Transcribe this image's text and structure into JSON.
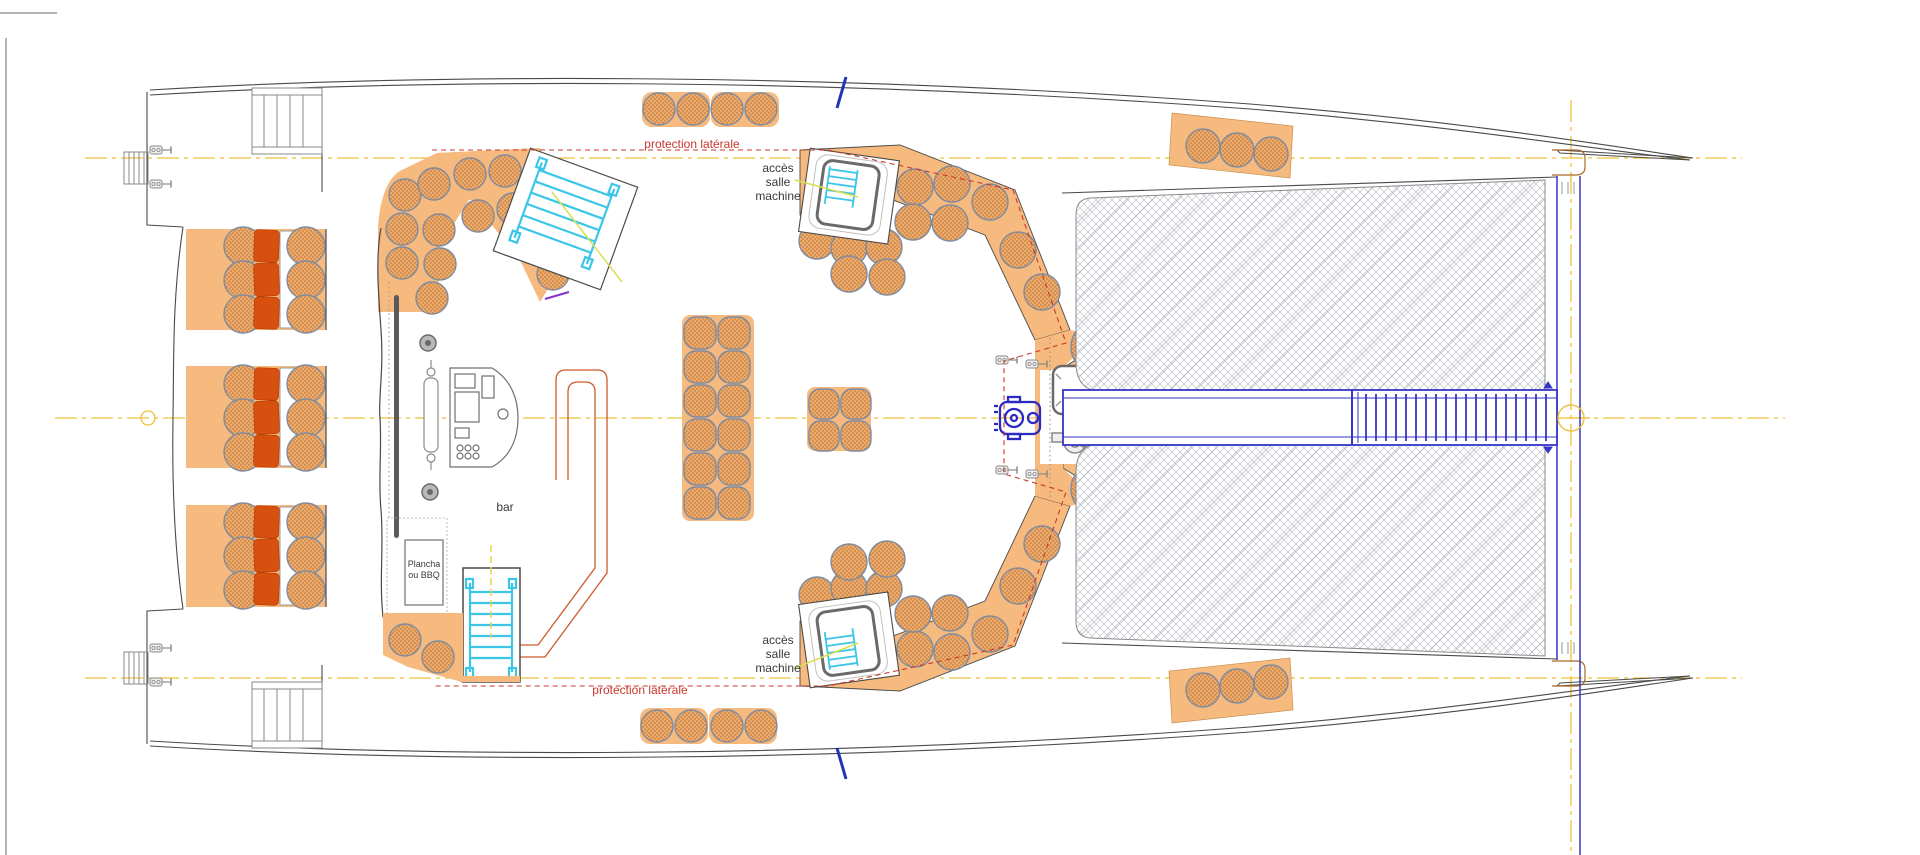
{
  "drawing": {
    "type": "catamaran-deck-plan",
    "labels": {
      "protection_top": "protection latérale",
      "protection_bottom": "protection latérale",
      "acces_top": [
        "accès",
        "salle",
        "machine"
      ],
      "acces_bottom": [
        "accès",
        "salle",
        "machine"
      ],
      "bar": "bar",
      "plancha": [
        "Plancha",
        "ou BBQ"
      ]
    },
    "colors": {
      "cushion_orange": "#f7ba7e",
      "cushion_dot": "#9a7142",
      "backrest_red": "#d8500f",
      "protection_dash_red": "#c8372d",
      "centerline_yellow": "#efc13b",
      "leader_yellow_green": "#d9de52",
      "stair_cyan": "#3bc6e8",
      "gangway_blue": "#3535c8",
      "accent_purple": "#8633c9",
      "outline_gray": "#4a4a4a",
      "net_gray": "#b3b9c2"
    },
    "icons": [
      "engine-hatch-ladder-icon",
      "helm-windlass-icon",
      "winch-icon",
      "cleat-icon",
      "swim-ladder-icon",
      "stern-stairs-icon",
      "galley-console-icon",
      "mast-center-icon",
      "nav-mark-icon"
    ]
  }
}
